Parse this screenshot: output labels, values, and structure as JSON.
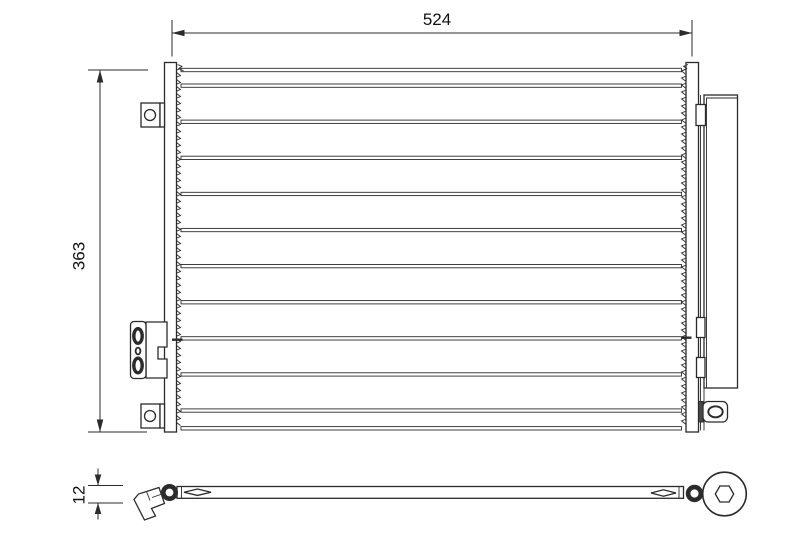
{
  "drawing": {
    "dimensions": {
      "width": "524",
      "height": "363",
      "depth": "12"
    },
    "core_tube_rows": 10,
    "colors": {
      "line": "#2b2b2b",
      "text": "#111111",
      "background": "#ffffff"
    }
  }
}
